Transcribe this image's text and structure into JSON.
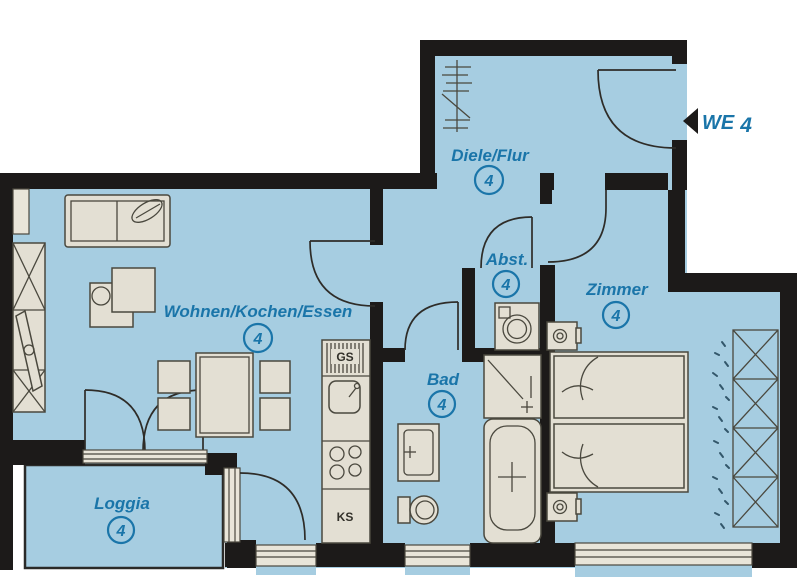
{
  "unit": {
    "label": "WE",
    "number": "4"
  },
  "rooms": [
    {
      "id": "diele",
      "name": "Diele/Flur",
      "number": "4"
    },
    {
      "id": "abst",
      "name": "Abst.",
      "number": "4"
    },
    {
      "id": "zimmer",
      "name": "Zimmer",
      "number": "4"
    },
    {
      "id": "wohnen",
      "name": "Wohnen/Kochen/Essen",
      "number": "4"
    },
    {
      "id": "bad",
      "name": "Bad",
      "number": "4"
    },
    {
      "id": "loggia",
      "name": "Loggia",
      "number": "4"
    }
  ],
  "appliances": {
    "dishwasher": "GS",
    "fridge": "KS"
  },
  "colors": {
    "floor": "#a6cde1",
    "wall": "#1c1a19",
    "label": "#1a75a9",
    "furniture": "#e3dfd3",
    "furniture_outline": "#4a483e"
  }
}
